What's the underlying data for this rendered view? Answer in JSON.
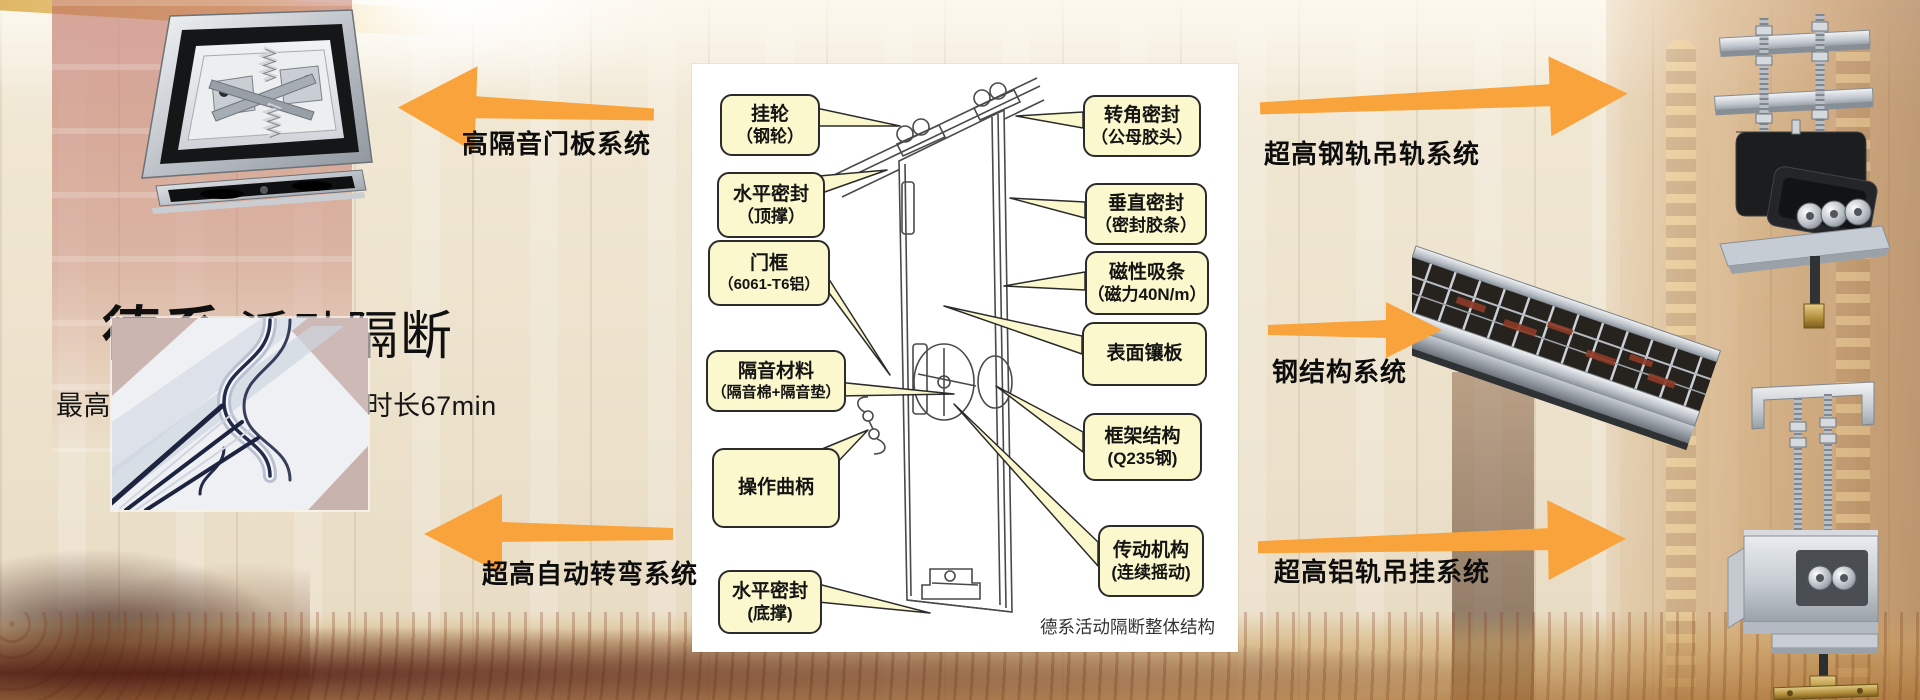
{
  "header": {
    "title_bold": "德系",
    "title_rest": "活动隔断",
    "subtitle": "最高隔音系数56db，防火时长67min"
  },
  "arrows": {
    "door_panel": {
      "label": "高隔音门板系统",
      "direction": "left"
    },
    "auto_turn": {
      "label": "超高自动转弯系统",
      "direction": "left"
    },
    "steel_rail": {
      "label": "超高钢轨吊轨系统",
      "direction": "right"
    },
    "steel_structure": {
      "label": "钢结构系统",
      "direction": "right"
    },
    "alu_rail": {
      "label": "超高铝轨吊挂系统",
      "direction": "right"
    }
  },
  "diagram": {
    "caption": "德系活动隔断整体结构",
    "left_callouts": [
      {
        "line1": "挂轮",
        "line2": "（钢轮）"
      },
      {
        "line1": "水平密封",
        "line2": "（顶撑）"
      },
      {
        "line1": "门框",
        "line2": "（6061-T6铝）"
      },
      {
        "line1": "隔音材料",
        "line2": "（隔音棉+隔音垫）"
      },
      {
        "line1": "操作曲柄",
        "line2": ""
      },
      {
        "line1": "水平密封",
        "line2": "(底撑)"
      }
    ],
    "right_callouts": [
      {
        "line1": "转角密封",
        "line2": "（公母胶头）"
      },
      {
        "line1": "垂直密封",
        "line2": "（密封胶条）"
      },
      {
        "line1": "磁性吸条",
        "line2": "（磁力40N/m）"
      },
      {
        "line1": "表面镶板",
        "line2": ""
      },
      {
        "line1": "框架结构",
        "line2": "(Q235钢)"
      },
      {
        "line1": "传动机构",
        "line2": "(连续摇动)"
      }
    ]
  },
  "colors": {
    "arrow_orange": "#F9A33C",
    "callout_bg": "#FBF8CD",
    "callout_border": "#2B2B2B",
    "diagram_bg": "#FFFFFF",
    "background_cream": "#EFE6D2",
    "text_black": "#111111"
  }
}
